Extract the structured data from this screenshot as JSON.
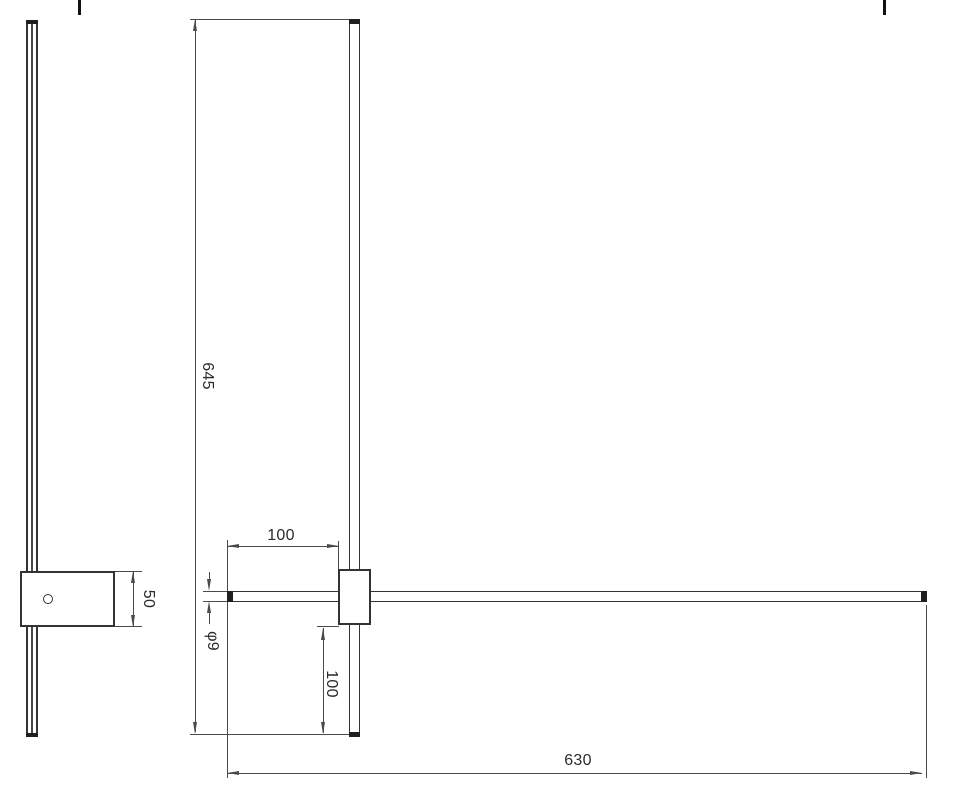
{
  "drawing": {
    "type": "technical-dimension-drawing",
    "subject": "linear wall light fixture, side view and front view with dimensions",
    "colors": {
      "object_line": "#333333",
      "dimension_line": "#4a4a4a",
      "end_cap": "#1f1f1f",
      "text": "#2a2a2a",
      "background": "#ffffff"
    },
    "views": {
      "side_view": {
        "parts": [
          "vertical-bar-profile",
          "mounting-plate",
          "screw-hole"
        ]
      },
      "front_view": {
        "parts": [
          "vertical-bar",
          "horizontal-bar",
          "mounting-block"
        ]
      }
    },
    "dimensions": {
      "total_height": "645",
      "total_width": "630",
      "left_overhang": "100",
      "bottom_overhang": "100",
      "tube_diameter": "φ9",
      "bracket_height": "50"
    }
  }
}
